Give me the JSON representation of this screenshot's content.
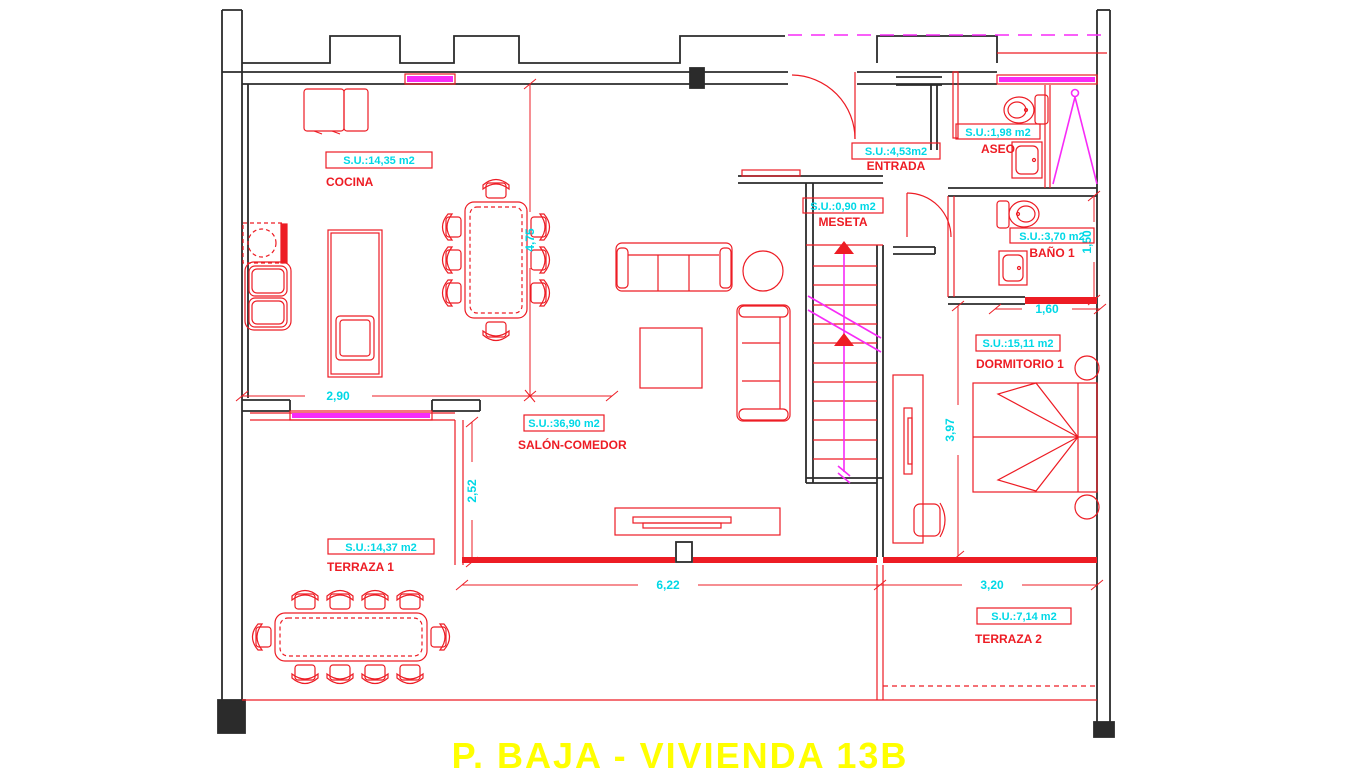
{
  "title": "P. BAJA - VIVIENDA 13B",
  "rooms": {
    "cocina": {
      "name": "COCINA",
      "area": "S.U.:14,35 m2"
    },
    "salon": {
      "name": "SALÓN-COMEDOR",
      "area": "S.U.:36,90 m2"
    },
    "entrada": {
      "name": "ENTRADA",
      "area": "S.U.:4,53m2"
    },
    "aseo": {
      "name": "ASEO",
      "area": "S.U.:1,98 m2"
    },
    "meseta": {
      "name": "MESETA",
      "area": "S.U.:0,90 m2"
    },
    "bano1": {
      "name": "BAÑO 1",
      "area": "S.U.:3,70 m2"
    },
    "dormitorio1": {
      "name": "DORMITORIO 1",
      "area": "S.U.:15,11 m2"
    },
    "terraza1": {
      "name": "TERRAZA 1",
      "area": "S.U.:14,37 m2"
    },
    "terraza2": {
      "name": "TERRAZA 2",
      "area": "S.U.:7,14 m2"
    }
  },
  "dimensions": {
    "kitchen_height": "4,75",
    "kitchen_width": "2,90",
    "terrace1_height": "2,52",
    "salon_width": "6,22",
    "terrace2_width": "3,20",
    "bath1_width": "1,60",
    "bath1_height": "1,50",
    "bedroom_height": "3,97"
  },
  "colors": {
    "walls_black": "#2b2b2b",
    "cad_red": "#ed1c24",
    "dimension_cyan": "#00d8e6",
    "accent_magenta": "#f72bf7",
    "title_yellow": "#ffff00",
    "background": "#ffffff"
  }
}
